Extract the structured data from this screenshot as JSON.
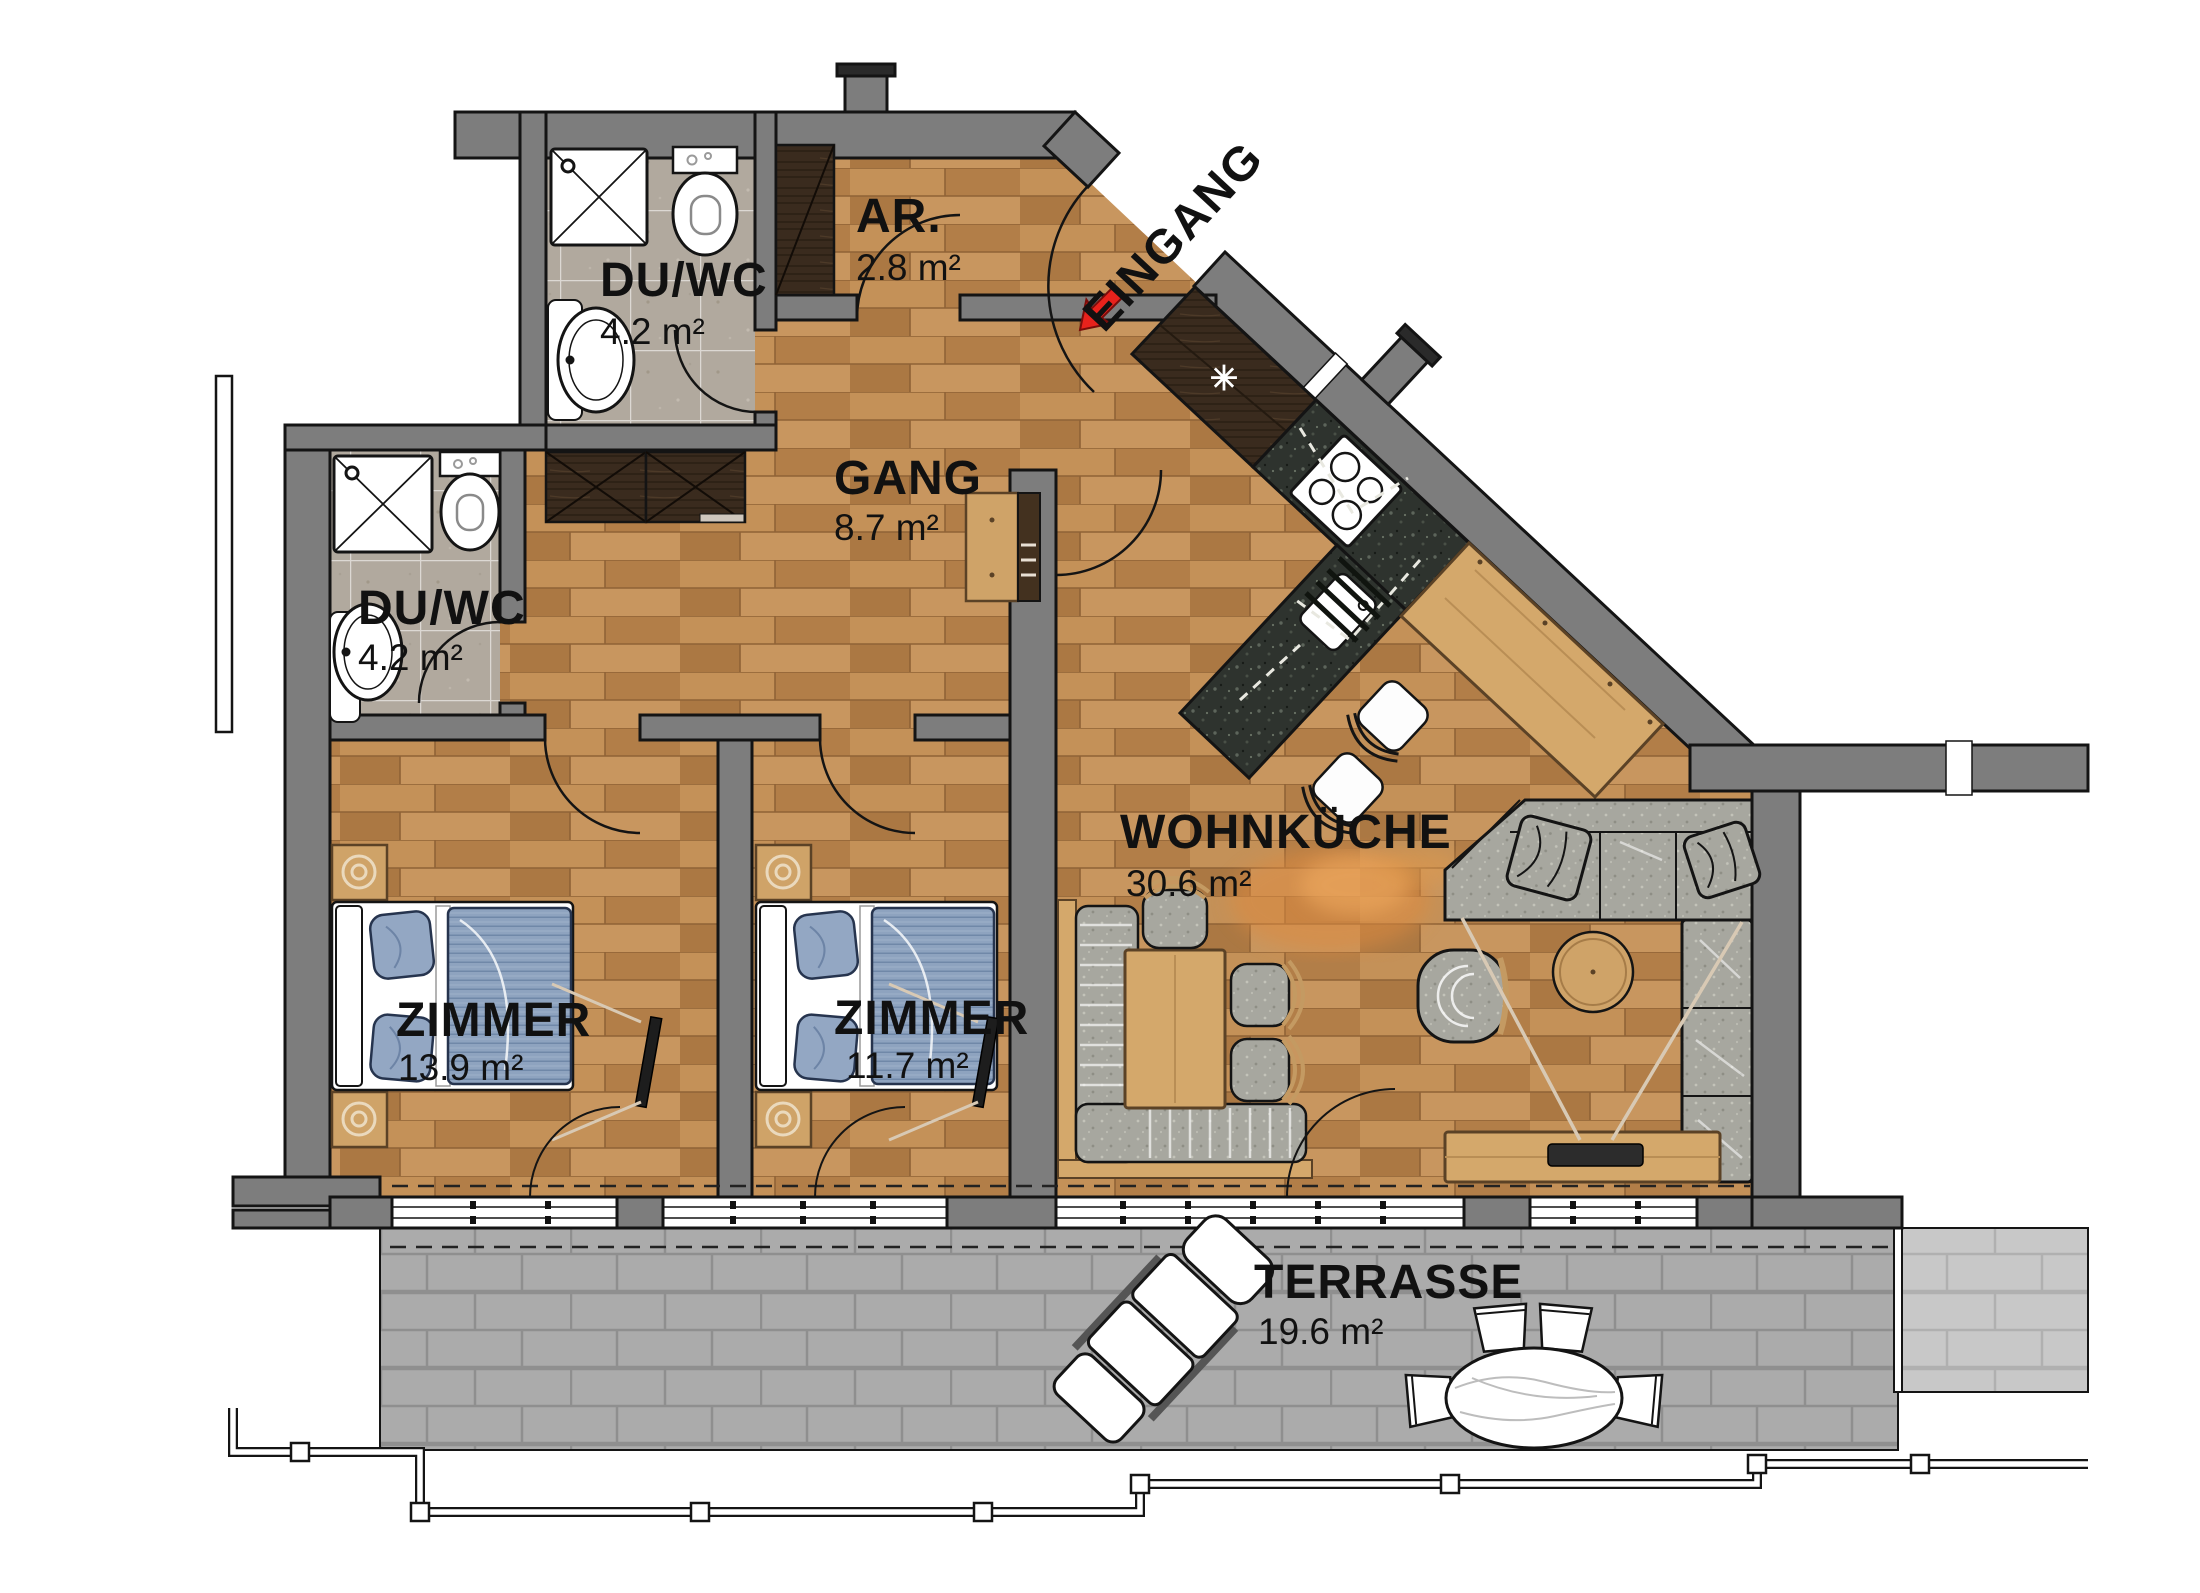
{
  "plan": {
    "entrance_label": "EINGANG",
    "rooms": [
      {
        "id": "duwc-top",
        "name": "DU/WC",
        "area": "4.2 m²"
      },
      {
        "id": "ar",
        "name": "AR.",
        "area": "2.8 m²"
      },
      {
        "id": "gang",
        "name": "GANG",
        "area": "8.7 m²"
      },
      {
        "id": "duwc-left",
        "name": "DU/WC",
        "area": "4.2 m²"
      },
      {
        "id": "zimmer-1",
        "name": "ZIMMER",
        "area": "13.9 m²"
      },
      {
        "id": "zimmer-2",
        "name": "ZIMMER",
        "area": "11.7 m²"
      },
      {
        "id": "wohnkueche",
        "name": "WOHNKÜCHE",
        "area": "30.6 m²"
      },
      {
        "id": "terrasse",
        "name": "TERRASSE",
        "area": "19.6 m²"
      }
    ],
    "symbols": {
      "kitchen_asterisk": "✳"
    },
    "colors": {
      "wall": "#7d7d7d",
      "wood_floor": "#bc8a55",
      "bath_tile": "#b1a99e",
      "terrace_tile": "#ababab",
      "counter_granite": "#2e332e",
      "accent_red": "#e8221c",
      "fabric": "#a7a79f",
      "furniture_wood": "#d4a86b",
      "dark_wood": "#3a2b1e",
      "bed_textile": "#8ea3bf"
    }
  }
}
